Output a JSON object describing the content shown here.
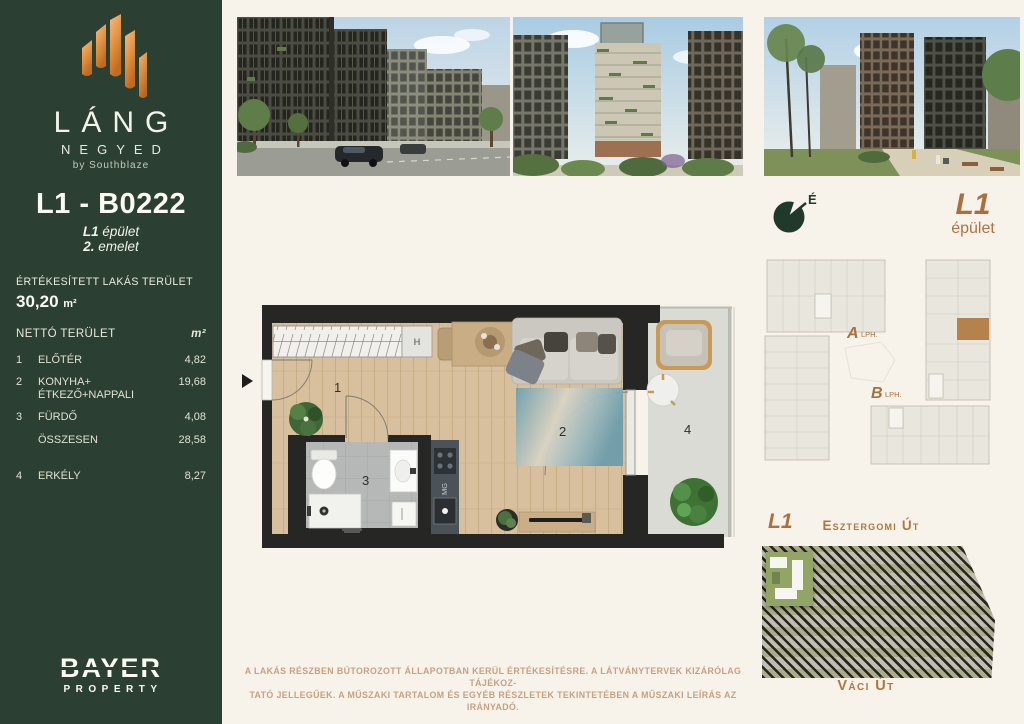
{
  "colors": {
    "brand_green": "#2b4032",
    "cream": "#f8f3ea",
    "flame_orange": "#d98a3e",
    "accent_brown": "#a9703f",
    "highlight_unit": "#b5824d"
  },
  "sidebar": {
    "brand": {
      "title": "LÁNG",
      "subtitle": "NEGYED",
      "byline": "by Southblaze"
    },
    "unit_id": "L1 - B0222",
    "unit_building": "L1",
    "unit_building_suffix": "épület",
    "unit_floor": "2.",
    "unit_floor_suffix": "emelet",
    "area": {
      "title": "ÉRTÉKESÍTETT LAKÁS TERÜLET",
      "value": "30,20",
      "unit": "m²"
    },
    "table": {
      "header_label": "NETTÓ TERÜLET",
      "header_unit": "m²",
      "rows": [
        {
          "num": "1",
          "label": "ELŐTÉR",
          "value": "4,82"
        },
        {
          "num": "2",
          "label": "KONYHA+",
          "label2": "ÉTKEZŐ+NAPPALI",
          "value": "19,68"
        },
        {
          "num": "3",
          "label": "FÜRDŐ",
          "value": "4,08"
        },
        {
          "num": "",
          "label": "ÖSSZESEN",
          "value": "28,58"
        },
        {
          "num": "4",
          "label": "ERKÉLY",
          "value": "8,27"
        }
      ]
    },
    "footer_logo": {
      "line1": "BAYER",
      "line2": "PROPERTY"
    }
  },
  "compass": {
    "north_label": "É"
  },
  "building_badge": {
    "title": "L1",
    "subtitle": "épület"
  },
  "floorplate": {
    "lift_a": "A",
    "lift_a_label": "LPH.",
    "lift_b": "B",
    "lift_b_label": "LPH."
  },
  "floorplan": {
    "rooms": {
      "r1": "1",
      "r2": "2",
      "r3": "3",
      "r4": "4"
    },
    "wardrobe_label": "H",
    "washer_label": "MG"
  },
  "site_map": {
    "building_label": "L1",
    "street_top": "Esztergomi Út",
    "street_bottom": "Váci Út"
  },
  "disclaimer": {
    "line1": "A LAKÁS RÉSZBEN BÚTOROZOTT ÁLLAPOTBAN KERÜL ÉRTÉKESÍTÉSRE. A LÁTVÁNYTERVEK KIZÁRÓLAG TÁJÉKOZ-",
    "line2": "TATÓ JELLEGŰEK. A MŰSZAKI TARTALOM ÉS EGYÉB RÉSZLETEK TEKINTETÉBEN A MŰSZAKI LEÍRÁS AZ IRÁNYADÓ."
  }
}
